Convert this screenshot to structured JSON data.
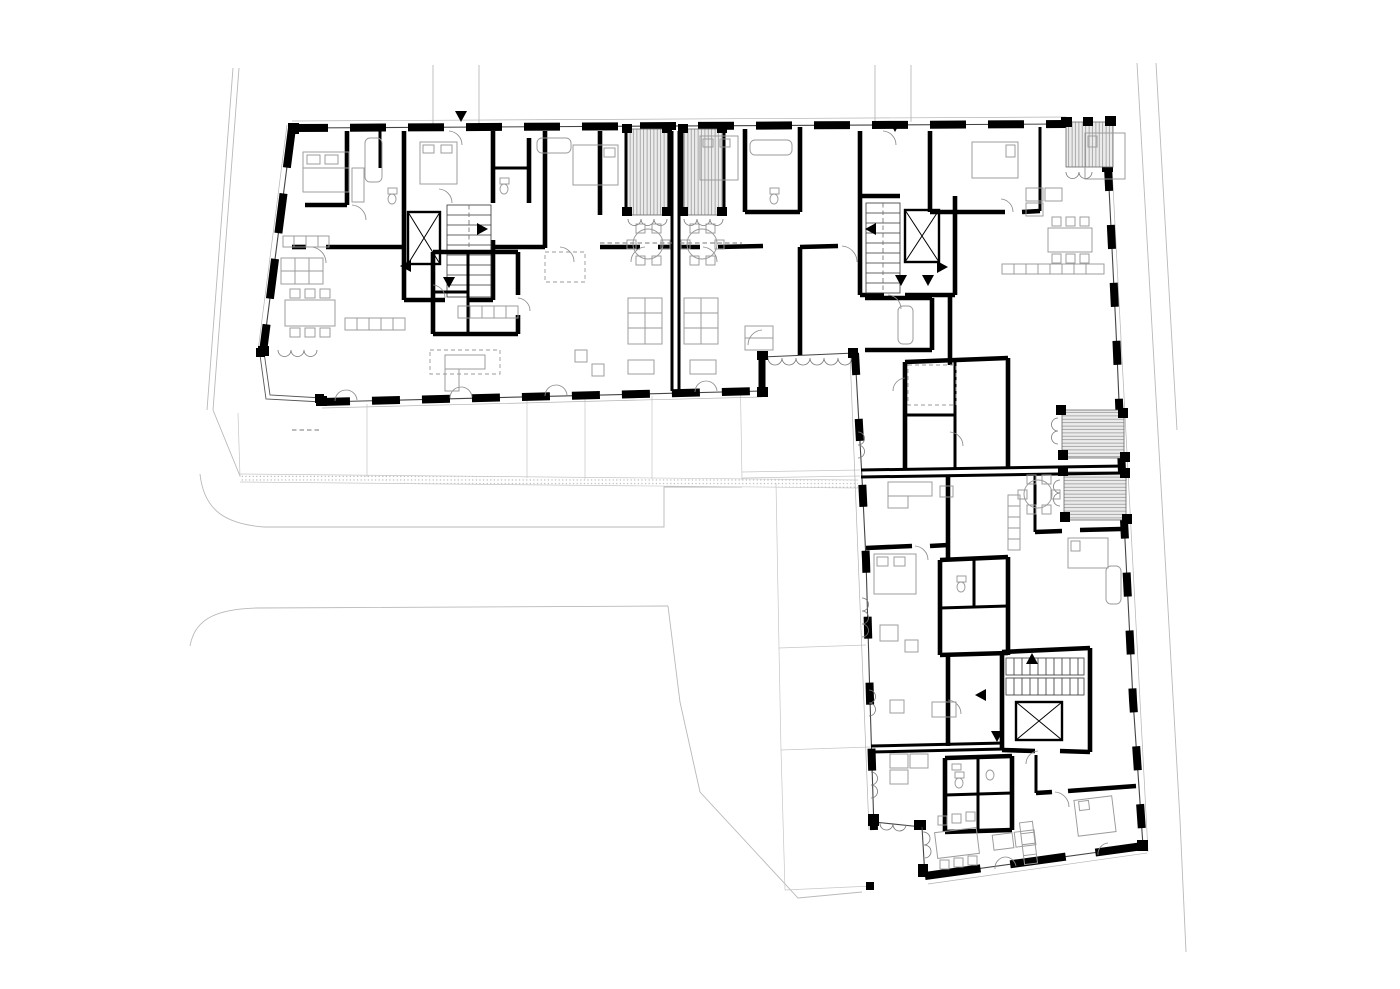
{
  "diagram": {
    "kind": "architectural floor plan",
    "description": "Upper floor plan of an L-shaped multi-unit residential building with stair cores, elevators, loggias, terraces and surrounding street lines",
    "elements": {
      "stair_cores": 3,
      "elevators": 3,
      "loggias": 5,
      "entrance_arrows": 12,
      "wings": 2
    }
  },
  "colors": {
    "background": "#ffffff",
    "wall": "#000000",
    "line": "#444444",
    "furniture": "#9a9a9a",
    "site": "#b9b9b9",
    "hatchline": "#8f8f8f",
    "hatchfill": "#ebebeb",
    "arc": "#8a8a8a"
  }
}
